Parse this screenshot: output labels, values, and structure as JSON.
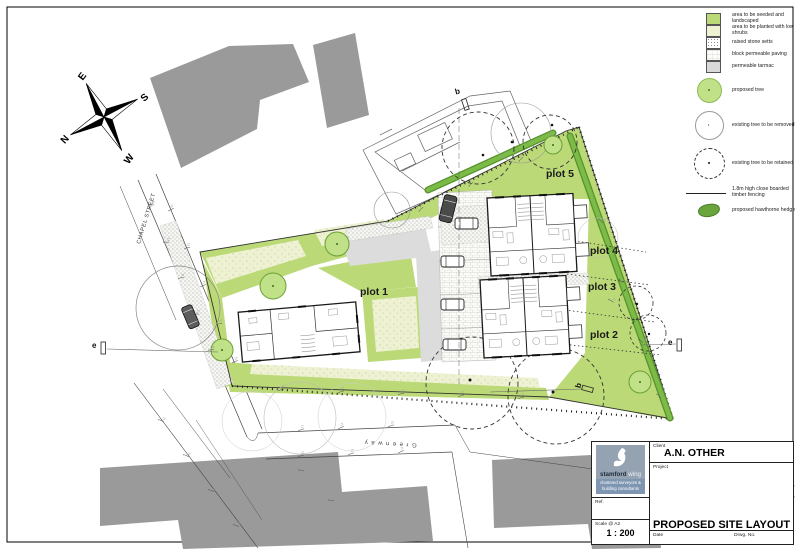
{
  "legend": {
    "items": [
      {
        "label": "area to be seeded and landscaped",
        "swatch": "seeded"
      },
      {
        "label": "area to be planted with low shrubs",
        "swatch": "shrubs"
      },
      {
        "label": "raised stone setts",
        "swatch": "setts"
      },
      {
        "label": "block permeable paving",
        "swatch": "paving"
      },
      {
        "label": "permeable tarmac",
        "swatch": "tarmac"
      },
      {
        "label": "proposed tree",
        "swatch": "tree-proposed"
      },
      {
        "label": "existing tree to be removed",
        "swatch": "tree-removed"
      },
      {
        "label": "existing tree to be retained",
        "swatch": "tree-retained"
      },
      {
        "label": "1.8m high close boarded timber fencing",
        "swatch": "fence"
      },
      {
        "label": "proposed hawthorne hedge",
        "swatch": "hedge"
      }
    ]
  },
  "compass": {
    "north": "N",
    "east": "E",
    "south": "S",
    "west": "W"
  },
  "plan": {
    "plots": [
      {
        "label": "plot 1"
      },
      {
        "label": "plot 2"
      },
      {
        "label": "plot 3"
      },
      {
        "label": "plot 4"
      },
      {
        "label": "plot 5"
      }
    ],
    "streets": {
      "chapel_street": "CHAPEL STREET",
      "greenway": "Greenway"
    },
    "section_markers": {
      "b": "b",
      "e": "e"
    }
  },
  "title_block": {
    "client_label": "Client",
    "client": "A.N. OTHER",
    "project_label": "Project",
    "project_title": "PROPOSED SITE LAYOUT",
    "ref_label": "Ref.",
    "scale_label": "Scale @ A2",
    "scale_value": "1 : 200",
    "date_label": "Date",
    "drawing_no_label": "Drwg. No.",
    "logo": {
      "name_bold": "stamford",
      "name_light": " wing",
      "tagline_line1": "chartered surveyors &",
      "tagline_line2": "building consultants"
    }
  },
  "colors": {
    "seeded_green": "#bcd977",
    "shrub_pale": "#eef2d2",
    "hedge_green": "#69a53b",
    "tarmac_gray": "#dcdcdc",
    "building_gray": "#9a9a9a"
  }
}
